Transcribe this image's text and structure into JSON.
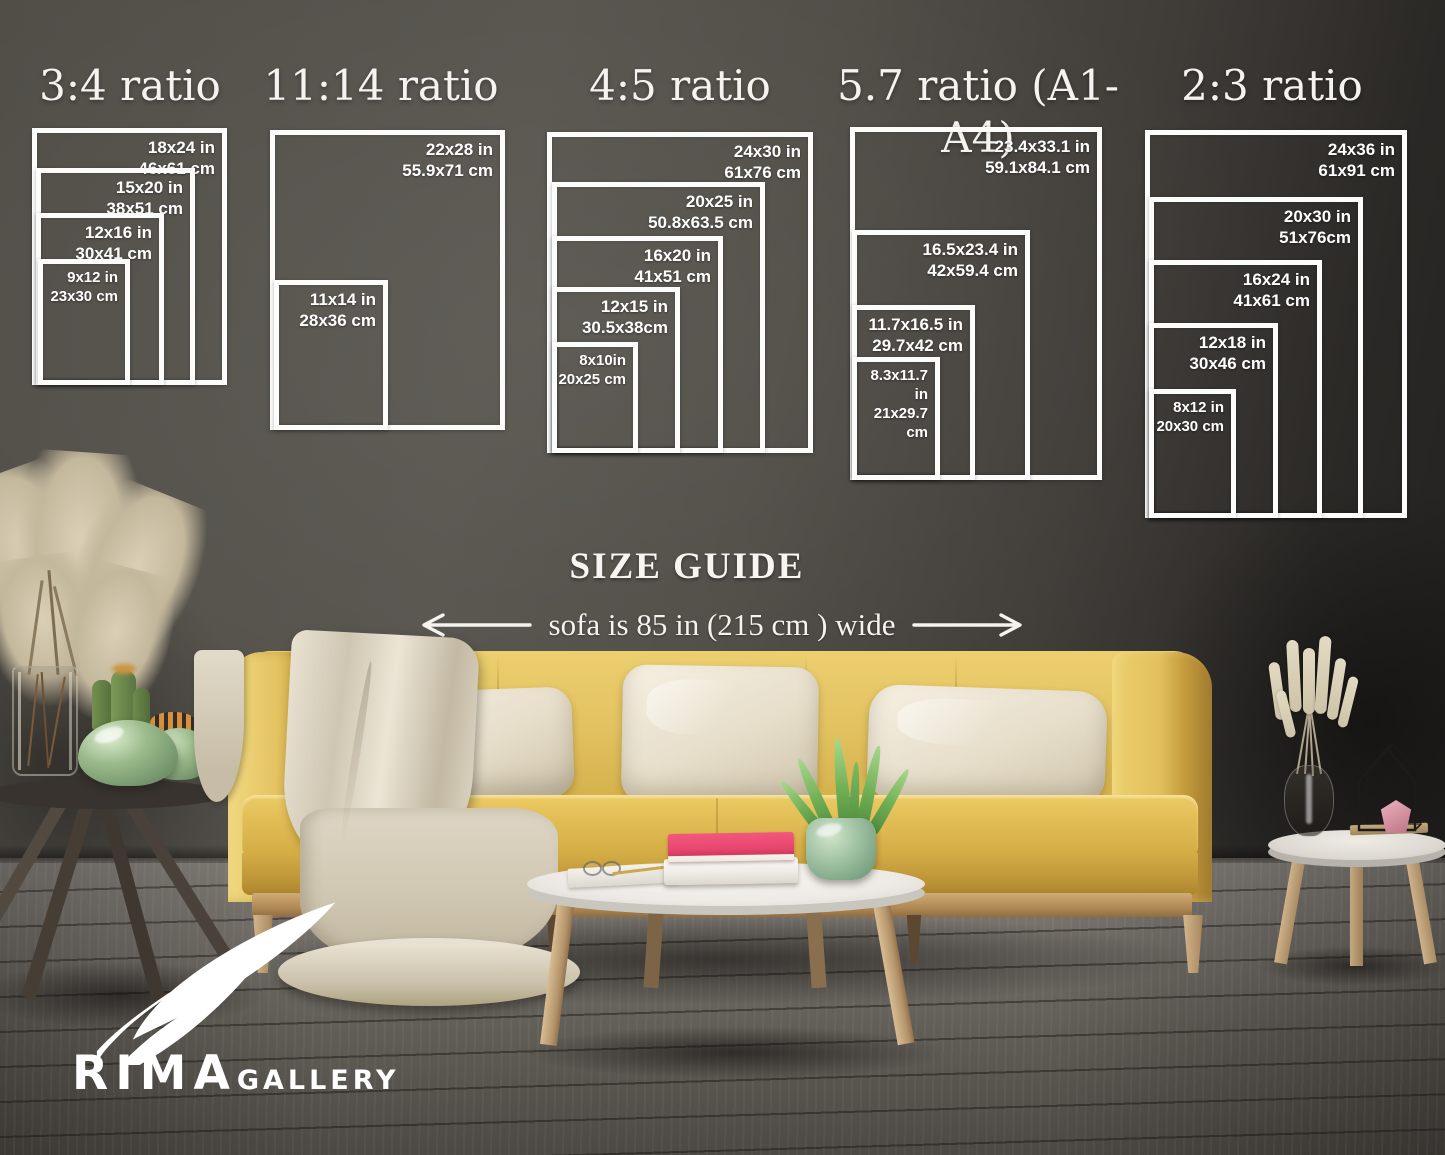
{
  "size_guide": {
    "heading": "SIZE GUIDE",
    "sofa_note": "sofa is 85 in (215 cm ) wide",
    "groups": [
      {
        "title": "3:4 ratio",
        "sizes": [
          {
            "in": "18x24 in",
            "cm": "46x61 cm"
          },
          {
            "in": "15x20 in",
            "cm": "38x51 cm"
          },
          {
            "in": "12x16 in",
            "cm": "30x41 cm"
          },
          {
            "in": "9x12 in",
            "cm": "23x30 cm"
          }
        ]
      },
      {
        "title": "11:14 ratio",
        "sizes": [
          {
            "in": "22x28 in",
            "cm": "55.9x71 cm"
          },
          {
            "in": "11x14 in",
            "cm": "28x36 cm"
          }
        ]
      },
      {
        "title": "4:5 ratio",
        "sizes": [
          {
            "in": "24x30 in",
            "cm": "61x76 cm"
          },
          {
            "in": "20x25 in",
            "cm": "50.8x63.5 cm"
          },
          {
            "in": "16x20 in",
            "cm": "41x51 cm"
          },
          {
            "in": "12x15 in",
            "cm": "30.5x38cm"
          },
          {
            "in": "8x10in",
            "cm": "20x25 cm"
          }
        ]
      },
      {
        "title": "5.7 ratio (A1-A4)",
        "sizes": [
          {
            "in": "23.4x33.1 in",
            "cm": "59.1x84.1 cm"
          },
          {
            "in": "16.5x23.4 in",
            "cm": "42x59.4 cm"
          },
          {
            "in": "11.7x16.5 in",
            "cm": "29.7x42 cm"
          },
          {
            "in": "8.3x11.7 in",
            "cm": "21x29.7 cm"
          }
        ]
      },
      {
        "title": "2:3 ratio",
        "sizes": [
          {
            "in": "24x36 in",
            "cm": "61x91 cm"
          },
          {
            "in": "20x30 in",
            "cm": "51x76cm"
          },
          {
            "in": "16x24 in",
            "cm": "41x61 cm"
          },
          {
            "in": "12x18 in",
            "cm": "30x46 cm"
          },
          {
            "in": "8x12 in",
            "cm": "20x30 cm"
          }
        ]
      }
    ]
  },
  "brand": {
    "name": "RIMA",
    "suffix": "GALLERY"
  },
  "colors": {
    "wall": "#53504a",
    "floor": "#6e6a64",
    "sofa_yellow": "#ddba55",
    "pillow_cream": "#eee7d6",
    "blanket_beige": "#ddd5c3",
    "table_white": "#f1efeb",
    "book_pink": "#e8476f",
    "plant_green": "#6fae54",
    "vase_green": "#94b286",
    "wood_light": "#c9a777",
    "frame_white": "#fcfcfb",
    "text_white": "#ffffff"
  }
}
